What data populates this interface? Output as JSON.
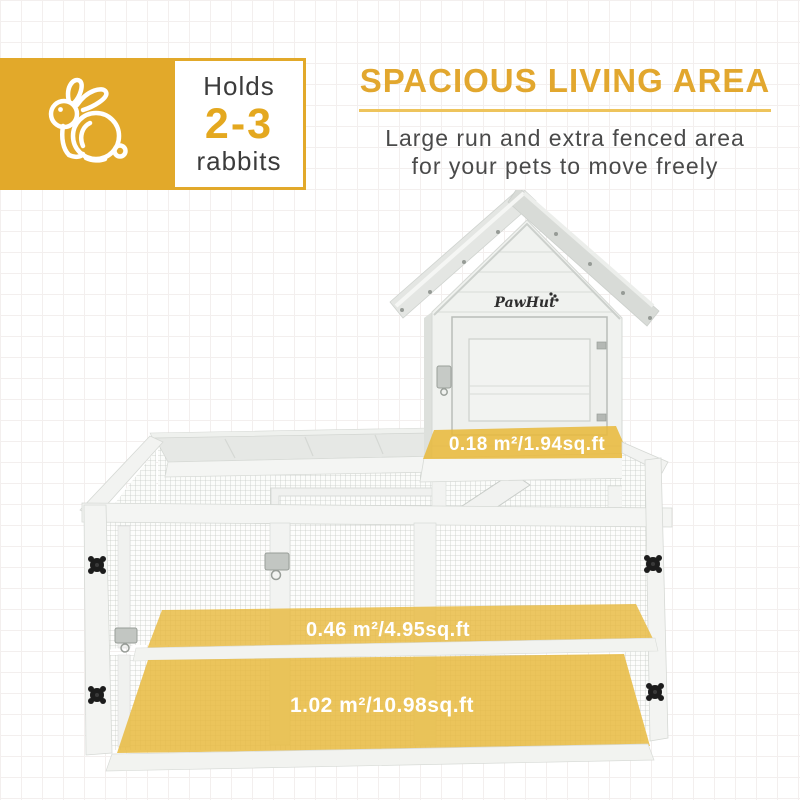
{
  "badge": {
    "holds": "Holds",
    "count": "2-3",
    "animal": "rabbits"
  },
  "headline": {
    "title": "SPACIOUS LIVING AREA",
    "subtitle_line1": "Large run and extra fenced area",
    "subtitle_line2": "for your pets to move freely"
  },
  "hutch": {
    "brand": "PawHut",
    "area_labels": {
      "house_floor": "0.18 m²/1.94sq.ft",
      "run_floor": "0.46 m²/4.95sq.ft",
      "total_floor": "1.02 m²/10.98sq.ft"
    }
  },
  "colors": {
    "accent_gold": "#E2A72E",
    "badge_gold": "#E2A92A",
    "underline_gold": "#EEC45C",
    "overlay_yellow": "#E8BA3E",
    "text_dark": "#3C3C3C",
    "wood_white": "#F3F4F2",
    "roof_gray": "#DCDFDB",
    "mesh_gray": "#C7CCC7",
    "knob_black": "#1C1C1C"
  }
}
